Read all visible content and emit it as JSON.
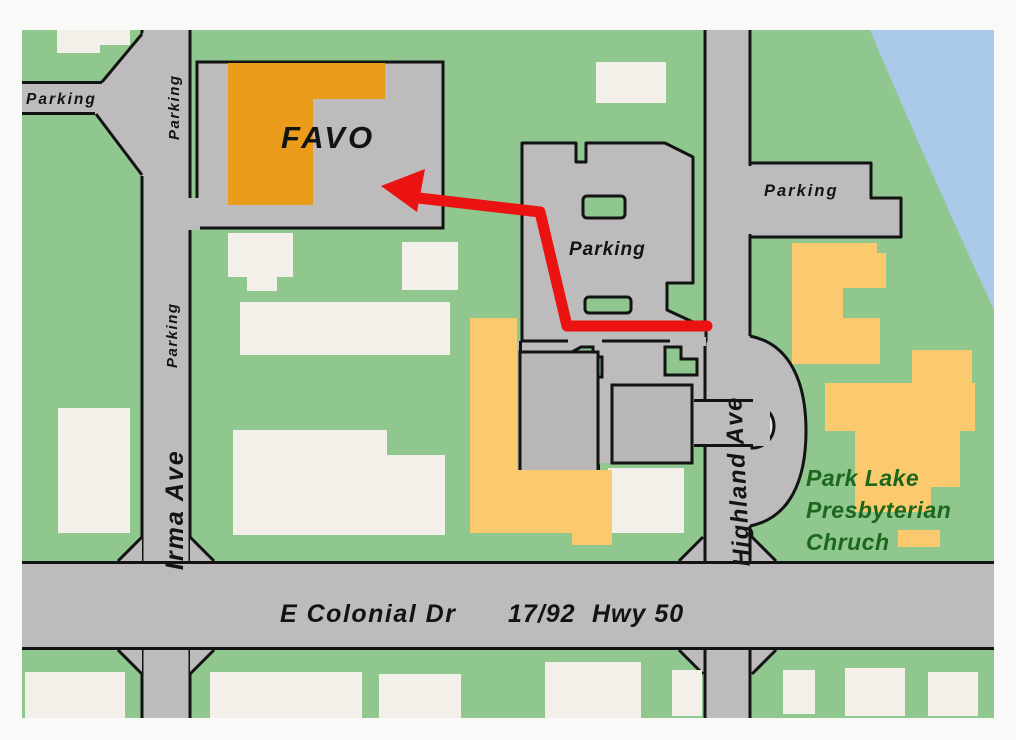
{
  "map": {
    "title": "FAVO location map",
    "labels": {
      "favo": "FAVO",
      "parking_nw": "Parking",
      "parking_irma_north": "Parking",
      "parking_irma_mid": "Parking",
      "parking_central": "Parking",
      "parking_east": "Parking",
      "irma_ave": "Irma Ave",
      "highland_ave": "Highland Ave",
      "e_colonial_dr": "E Colonial Dr",
      "hwy_17_92": "17/92",
      "hwy_50": "Hwy 50",
      "church_line1": "Park Lake",
      "church_line2": "Presbyterian",
      "church_line3": "Chruch"
    },
    "colors": {
      "land_green": "#8fc78f",
      "road_gray": "#bdbbbc",
      "outline_black": "#131313",
      "building_white": "#f2f0e9",
      "building_gray": "#b9b7b8",
      "favo_orange": "#eb9c1b",
      "church_yellow": "#fcca6e",
      "water_blue": "#abc9e9",
      "route_red": "#ea1311",
      "church_text_green": "#1c671c",
      "island_green": "#8fc78f",
      "notch_fill": "#e9e9e1"
    }
  }
}
